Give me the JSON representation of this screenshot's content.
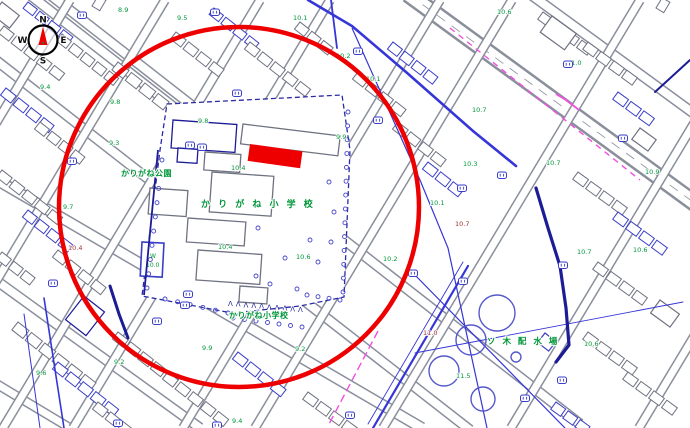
{
  "title": "city-plan-map",
  "colors": {
    "street_gray": "#8a8f9c",
    "building_gray": "#6f7280",
    "building_blue": "#3a3ec8",
    "navy": "#1c1c96",
    "blue_line": "#3535d8",
    "magenta": "#f050e0",
    "label_green": "#009639",
    "label_darkred": "#a03030",
    "annotation_red": "#ee0000",
    "tree_blue": "#4646cc",
    "tank_blue": "#5558cc",
    "campus_dash": "#2a2aa8"
  },
  "compass": {
    "n": "N",
    "e": "E",
    "s": "S",
    "w": "W",
    "cx": 43,
    "cy": 40,
    "r": 14.5
  },
  "annotations": {
    "circle": {
      "cx": 239,
      "cy": 207,
      "r": 180,
      "stroke_width": 4.5
    },
    "rect": {
      "x": 250,
      "y": 144,
      "w": 53,
      "h": 17,
      "rot": 8
    }
  },
  "place_labels": [
    {
      "text": "かりがね公園",
      "x": 121,
      "y": 176,
      "fs": 8,
      "ls": 0.5
    },
    {
      "text": "か り が ね 小 学 校",
      "x": 201,
      "y": 207,
      "fs": 9,
      "ls": 2.5
    },
    {
      "text": "かりがね小学校",
      "x": 229,
      "y": 318,
      "fs": 8,
      "ls": 0.5
    },
    {
      "text": "ソ 木 配 水 場",
      "x": 487,
      "y": 344,
      "fs": 8.5,
      "ls": 2
    }
  ],
  "pool_labels": [
    {
      "text": "W",
      "x": 150,
      "y": 258
    },
    {
      "text": "10.0",
      "x": 146,
      "y": 267
    }
  ],
  "elevation_labels": [
    [
      118,
      7,
      "8.9"
    ],
    [
      177,
      15,
      "9.5"
    ],
    [
      293,
      15,
      "10.1"
    ],
    [
      336,
      53,
      "10.2"
    ],
    [
      366,
      76,
      "10.1"
    ],
    [
      497,
      9,
      "10.6"
    ],
    [
      567,
      60,
      "11.0"
    ],
    [
      472,
      107,
      "10.7"
    ],
    [
      40,
      84,
      "9.4"
    ],
    [
      110,
      99,
      "9.8"
    ],
    [
      198,
      118,
      "9.8"
    ],
    [
      109,
      140,
      "9.3"
    ],
    [
      336,
      134,
      "9.9"
    ],
    [
      231,
      165,
      "10.4"
    ],
    [
      463,
      161,
      "10.3"
    ],
    [
      546,
      160,
      "10.7"
    ],
    [
      645,
      169,
      "10.9"
    ],
    [
      63,
      204,
      "9.7"
    ],
    [
      430,
      200,
      "10.1"
    ],
    [
      218,
      244,
      "10.4"
    ],
    [
      296,
      254,
      "10.6"
    ],
    [
      383,
      256,
      "10.2"
    ],
    [
      633,
      247,
      "10.6"
    ],
    [
      577,
      249,
      "10.7"
    ],
    [
      36,
      370,
      "9.6"
    ],
    [
      114,
      359,
      "9.2"
    ],
    [
      202,
      345,
      "9.9"
    ],
    [
      295,
      346,
      "9.2"
    ],
    [
      456,
      373,
      "11.5"
    ],
    [
      584,
      341,
      "10.6"
    ],
    [
      232,
      418,
      "9.4"
    ]
  ],
  "elevation_labels_red": [
    [
      455,
      221,
      "10.7"
    ],
    [
      423,
      330,
      "11.0"
    ],
    [
      68,
      245,
      "10.4"
    ]
  ],
  "markers": [
    [
      82,
      15
    ],
    [
      215,
      12
    ],
    [
      358,
      51
    ],
    [
      568,
      64
    ],
    [
      237,
      93
    ],
    [
      190,
      145
    ],
    [
      202,
      147
    ],
    [
      378,
      120
    ],
    [
      72,
      161
    ],
    [
      462,
      188
    ],
    [
      502,
      175
    ],
    [
      53,
      283
    ],
    [
      188,
      294
    ],
    [
      185,
      305
    ],
    [
      157,
      321
    ],
    [
      413,
      273
    ],
    [
      463,
      281
    ],
    [
      563,
      265
    ],
    [
      623,
      138
    ],
    [
      350,
      415
    ],
    [
      562,
      380
    ],
    [
      118,
      423
    ],
    [
      217,
      425
    ],
    [
      525,
      398
    ]
  ],
  "streets": [
    {
      "a": [
        30,
        -5
      ],
      "b": [
        580,
        424
      ],
      "cw": 11,
      "fw": 8
    },
    {
      "a": [
        -30,
        40
      ],
      "b": [
        470,
        430
      ],
      "cw": 11,
      "fw": 8
    },
    {
      "a": [
        -20,
        -60
      ],
      "b": [
        300,
        190
      ],
      "cw": 11,
      "fw": 8
    },
    {
      "a": [
        -10,
        176
      ],
      "b": [
        422,
        428
      ],
      "cw": 12,
      "fw": 9
    },
    {
      "a": [
        -10,
        276
      ],
      "b": [
        200,
        428
      ],
      "cw": 11,
      "fw": 8
    },
    {
      "a": [
        -10,
        380
      ],
      "b": [
        70,
        428
      ],
      "cw": 10,
      "fw": 7
    },
    {
      "a": [
        408,
        -6
      ],
      "b": [
        700,
        207
      ],
      "cw": 18,
      "fw": 13,
      "boulevard": true
    },
    {
      "a": [
        530,
        -6
      ],
      "b": [
        700,
        118
      ],
      "cw": 11,
      "fw": 8
    },
    {
      "a": [
        70,
        0
      ],
      "b": [
        -187,
        428
      ],
      "cw": 10,
      "fw": 7
    },
    {
      "a": [
        165,
        0
      ],
      "b": [
        -92,
        428
      ],
      "cw": 10,
      "fw": 7
    },
    {
      "a": [
        260,
        0
      ],
      "b": [
        3,
        428
      ],
      "cw": 10,
      "fw": 7
    },
    {
      "a": [
        330,
        0
      ],
      "b": [
        73,
        428
      ],
      "cw": 10,
      "fw": 7
    },
    {
      "a": [
        440,
        0
      ],
      "b": [
        183,
        428
      ],
      "cw": 10,
      "fw": 7
    },
    {
      "a": [
        512,
        0
      ],
      "b": [
        255,
        428
      ],
      "cw": 10,
      "fw": 7
    },
    {
      "a": [
        640,
        0
      ],
      "b": [
        383,
        428
      ],
      "cw": 10,
      "fw": 7
    },
    {
      "a": [
        768,
        0
      ],
      "b": [
        511,
        428
      ],
      "cw": 10,
      "fw": 7
    },
    {
      "a": [
        896,
        0
      ],
      "b": [
        639,
        428
      ],
      "cw": 10,
      "fw": 7
    }
  ],
  "blocks": [
    [
      4,
      26,
      38,
      5,
      13,
      9,
      3,
      "g"
    ],
    [
      28,
      2,
      38,
      4,
      12,
      8,
      3,
      "b"
    ],
    [
      62,
      34,
      38,
      5,
      12,
      9,
      3,
      "g"
    ],
    [
      6,
      88,
      38,
      4,
      13,
      9,
      3,
      "b"
    ],
    [
      40,
      122,
      38,
      4,
      12,
      9,
      3,
      "g"
    ],
    [
      92,
      6,
      -59,
      3,
      12,
      9,
      4,
      "g"
    ],
    [
      118,
      62,
      38,
      4,
      14,
      10,
      3,
      "g"
    ],
    [
      2,
      170,
      38,
      5,
      13,
      9,
      3,
      "g"
    ],
    [
      28,
      210,
      38,
      4,
      12,
      9,
      3,
      "b"
    ],
    [
      58,
      250,
      38,
      4,
      13,
      9,
      3,
      "g"
    ],
    [
      2,
      252,
      38,
      3,
      12,
      9,
      3,
      "g"
    ],
    [
      18,
      322,
      38,
      6,
      14,
      10,
      3,
      "g"
    ],
    [
      58,
      362,
      38,
      5,
      13,
      9,
      3,
      "b"
    ],
    [
      118,
      332,
      38,
      5,
      13,
      9,
      3,
      "g"
    ],
    [
      168,
      372,
      38,
      5,
      13,
      9,
      3,
      "g"
    ],
    [
      238,
      352,
      38,
      4,
      13,
      9,
      3,
      "b"
    ],
    [
      98,
      402,
      38,
      4,
      13,
      9,
      3,
      "g"
    ],
    [
      176,
      32,
      38,
      4,
      13,
      9,
      3,
      "g"
    ],
    [
      214,
      8,
      38,
      4,
      12,
      8,
      3,
      "b"
    ],
    [
      250,
      42,
      38,
      5,
      13,
      9,
      3,
      "g"
    ],
    [
      300,
      22,
      38,
      3,
      12,
      9,
      3,
      "g"
    ],
    [
      358,
      72,
      38,
      4,
      13,
      9,
      3,
      "g"
    ],
    [
      393,
      42,
      38,
      4,
      12,
      9,
      3,
      "b"
    ],
    [
      398,
      122,
      38,
      4,
      13,
      9,
      3,
      "g"
    ],
    [
      428,
      162,
      38,
      3,
      13,
      9,
      3,
      "b"
    ],
    [
      543,
      12,
      36,
      4,
      13,
      9,
      3,
      "g"
    ],
    [
      588,
      42,
      36,
      4,
      13,
      9,
      3,
      "g"
    ],
    [
      618,
      92,
      36,
      3,
      13,
      9,
      3,
      "b"
    ],
    [
      656,
      8,
      -59,
      3,
      12,
      9,
      4,
      "g"
    ],
    [
      578,
      172,
      36,
      4,
      13,
      9,
      3,
      "g"
    ],
    [
      618,
      212,
      36,
      4,
      13,
      9,
      3,
      "b"
    ],
    [
      598,
      262,
      36,
      4,
      13,
      9,
      3,
      "g"
    ],
    [
      588,
      332,
      36,
      4,
      13,
      9,
      3,
      "g"
    ],
    [
      628,
      372,
      36,
      4,
      13,
      9,
      3,
      "g"
    ],
    [
      556,
      402,
      36,
      4,
      12,
      9,
      3,
      "b"
    ],
    [
      308,
      392,
      36,
      4,
      13,
      9,
      3,
      "g"
    ]
  ],
  "buildings": [
    [
      552,
      16,
      30,
      20,
      36,
      "g"
    ],
    [
      2,
      2,
      22,
      16,
      38,
      "g"
    ],
    [
      84,
      296,
      26,
      30,
      38,
      "n"
    ],
    [
      640,
      128,
      20,
      14,
      36,
      "g"
    ],
    [
      660,
      300,
      24,
      16,
      36,
      "g"
    ],
    [
      545,
      333,
      14,
      12,
      38,
      "b"
    ]
  ],
  "blue_lines_under": [
    {
      "pts": [
        [
          308,
          0
        ],
        [
          352,
          26
        ],
        [
          406,
          72
        ],
        [
          473,
          131
        ],
        [
          516,
          166
        ]
      ],
      "w": 2.6,
      "c": "blue_line"
    },
    {
      "pts": [
        [
          331,
          0
        ],
        [
          337,
          48
        ]
      ],
      "w": 1.8,
      "c": "blue_line"
    },
    {
      "pts": [
        [
          468,
          266
        ],
        [
          373,
          428
        ]
      ],
      "w": 2.2,
      "c": "blue_line"
    },
    {
      "pts": [
        [
          463,
          262
        ],
        [
          368,
          424
        ]
      ],
      "w": 0.9,
      "c": "blue_line"
    },
    {
      "pts": [
        [
          412,
          272
        ],
        [
          565,
          428
        ]
      ],
      "w": 1.2,
      "c": "blue_line"
    },
    {
      "pts": [
        [
          415,
          353
        ],
        [
          683,
          302
        ]
      ],
      "w": 0.9,
      "c": "blue_line"
    },
    {
      "pts": [
        [
          44,
          298
        ],
        [
          64,
          428
        ]
      ],
      "w": 1.6,
      "c": "blue_line"
    },
    {
      "pts": [
        [
          24,
          314
        ],
        [
          40,
          428
        ]
      ],
      "w": 1.0,
      "c": "blue_line"
    },
    {
      "pts": [
        [
          690,
          60
        ],
        [
          655,
          92
        ]
      ],
      "w": 2.0,
      "c": "navy"
    },
    {
      "pts": [
        [
          536,
          188
        ],
        [
          548,
          228
        ],
        [
          560,
          266
        ],
        [
          566,
          308
        ],
        [
          569,
          345
        ],
        [
          556,
          362
        ]
      ],
      "w": 3.2,
      "c": "navy"
    },
    {
      "pts": [
        [
          110,
          286
        ],
        [
          119,
          314
        ],
        [
          128,
          338
        ]
      ],
      "w": 3.0,
      "c": "navy"
    }
  ],
  "blue_lines_over": [
    {
      "pts": [
        [
          352,
          28
        ],
        [
          420,
          180
        ],
        [
          448,
          248
        ],
        [
          487,
          428
        ]
      ],
      "w": 1.2,
      "c": "blue_line"
    },
    {
      "pts": [
        [
          158,
          150
        ],
        [
          144,
          295
        ]
      ],
      "w": 1.8,
      "c": "navy"
    }
  ],
  "magenta_lines": [
    {
      "pts": [
        [
          450,
          28
        ],
        [
          640,
          180
        ]
      ],
      "w": 1.4,
      "dash": "6 5"
    },
    {
      "pts": [
        [
          556,
          94
        ],
        [
          566,
          100
        ],
        [
          579,
          110
        ]
      ],
      "w": 1.8,
      "dash": ""
    },
    {
      "pts": [
        [
          378,
          331
        ],
        [
          328,
          426
        ]
      ],
      "w": 1.4,
      "dash": "8 4"
    }
  ],
  "campus": {
    "poly": [
      [
        167,
        104
      ],
      [
        342,
        95
      ],
      [
        350,
        150
      ],
      [
        344,
        297
      ],
      [
        300,
        306
      ],
      [
        232,
        313
      ],
      [
        142,
        296
      ],
      [
        152,
        215
      ],
      [
        160,
        150
      ]
    ],
    "buildings": [
      [
        173,
        120,
        64,
        28,
        4,
        "n"
      ],
      [
        178,
        148,
        20,
        14,
        4,
        "n"
      ],
      [
        243,
        124,
        98,
        20,
        7,
        "g"
      ],
      [
        205,
        152,
        36,
        18,
        4,
        "g"
      ],
      [
        212,
        172,
        62,
        40,
        4,
        "g"
      ],
      [
        150,
        188,
        38,
        26,
        4,
        "g"
      ],
      [
        188,
        218,
        58,
        24,
        4,
        "g"
      ],
      [
        198,
        250,
        64,
        30,
        4,
        "g"
      ],
      [
        240,
        286,
        28,
        16,
        4,
        "g"
      ]
    ],
    "pool": {
      "x": 142,
      "y": 242,
      "w": 22,
      "h": 34,
      "rot": 3
    }
  },
  "tanks": [
    {
      "c": [
        497,
        313
      ],
      "r": 18
    },
    {
      "c": [
        471,
        340
      ],
      "r": 15
    },
    {
      "c": [
        444,
        371
      ],
      "r": 15
    },
    {
      "c": [
        483,
        399
      ],
      "r": 12
    },
    {
      "c": [
        516,
        357
      ],
      "r": 5
    }
  ],
  "tree_rows": [
    {
      "a": [
        348,
        112
      ],
      "b": [
        343,
        292
      ],
      "n": 14
    },
    {
      "a": [
        162,
        160
      ],
      "b": [
        147,
        288
      ],
      "n": 10
    },
    {
      "a": [
        165,
        299
      ],
      "b": [
        228,
        313
      ],
      "n": 6
    },
    {
      "a": [
        233,
        318
      ],
      "b": [
        302,
        327
      ],
      "n": 7
    },
    {
      "a": [
        307,
        295
      ],
      "b": [
        340,
        300
      ],
      "n": 4
    }
  ],
  "tree_scatter": [
    [
      256,
      276
    ],
    [
      270,
      284
    ],
    [
      297,
      289
    ],
    [
      318,
      262
    ],
    [
      331,
      242
    ],
    [
      334,
      212
    ],
    [
      329,
      182
    ],
    [
      258,
      228
    ],
    [
      285,
      258
    ],
    [
      310,
      240
    ]
  ],
  "fence_triangles": {
    "a": [
      228,
      306
    ],
    "b": [
      298,
      312
    ],
    "n": 10,
    "glyph": "Λ"
  }
}
